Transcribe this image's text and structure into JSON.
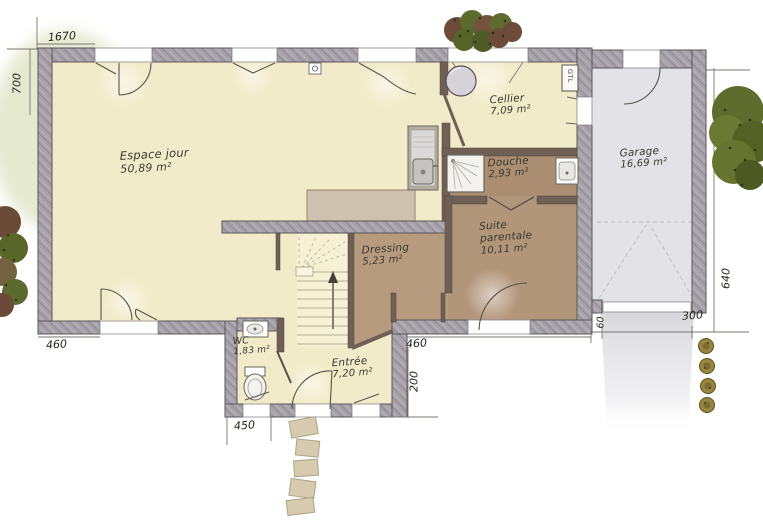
{
  "rooms": {
    "espace_jour": {
      "name": "Espace jour",
      "area": "50,89 m²"
    },
    "cellier": {
      "name": "Cellier",
      "area": "7,09 m²"
    },
    "douche": {
      "name": "Douche",
      "area": "2,93 m²"
    },
    "suite_parentale": {
      "line1": "Suite",
      "line2": "parentale",
      "area": "10,11 m²"
    },
    "dressing": {
      "name": "Dressing",
      "area": "5,23 m²"
    },
    "wc": {
      "name": "WC",
      "area": "1,83 m²"
    },
    "entree": {
      "name": "Entrée",
      "area": "7,20 m²"
    },
    "garage": {
      "name": "Garage",
      "area": "16,69 m²"
    }
  },
  "fixtures": {
    "gtl_label": "GTL"
  },
  "dimensions_cm": {
    "top_width": "1670",
    "left_height": "700",
    "living_wall": "460",
    "entry_block_width": "450",
    "suite_wall": "460",
    "entry_side": "200",
    "garage_setback": "60",
    "garage_door_width": "300",
    "garage_depth": "640"
  },
  "colors": {
    "floor_cream": "#f2ebc9",
    "floor_brown": "#b2967a",
    "wall_gray": "#a7a2a9",
    "garage_floor": "#e3e3e7",
    "counter_tan": "#cdc2ae",
    "foliage_green": "#5e6c2d"
  }
}
